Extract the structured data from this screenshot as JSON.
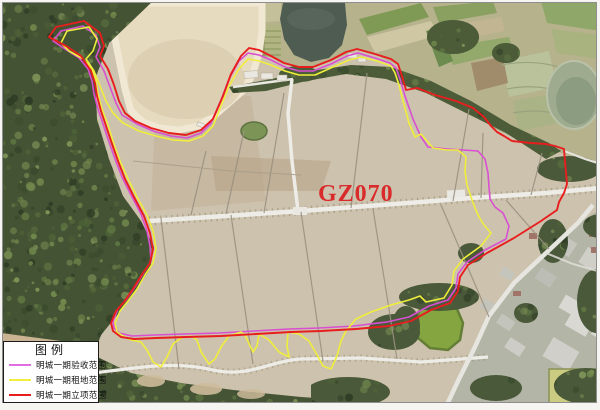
{
  "map": {
    "site_label": "GZ070",
    "site_label_color": "#d92b2b"
  },
  "legend": {
    "title": "图例",
    "items": [
      {
        "id": "acceptance",
        "label": "明城一期验收范围",
        "color": "#e06ee0"
      },
      {
        "id": "lease",
        "label": "明城一期租地范围",
        "color": "#f2ee3e"
      },
      {
        "id": "approval",
        "label": "明城一期立项范围",
        "color": "#e81e1e"
      }
    ]
  },
  "overlays": [
    {
      "name": "acceptance-boundary",
      "color": "#d94fd2",
      "width": 1.6,
      "closed": true,
      "points": [
        [
          52,
          40
        ],
        [
          60,
          30
        ],
        [
          82,
          25
        ],
        [
          95,
          34
        ],
        [
          99,
          46
        ],
        [
          95,
          56
        ],
        [
          103,
          70
        ],
        [
          109,
          86
        ],
        [
          115,
          102
        ],
        [
          121,
          114
        ],
        [
          136,
          123
        ],
        [
          152,
          130
        ],
        [
          170,
          135
        ],
        [
          186,
          137
        ],
        [
          200,
          132
        ],
        [
          210,
          122
        ],
        [
          220,
          99
        ],
        [
          228,
          78
        ],
        [
          238,
          60
        ],
        [
          247,
          52
        ],
        [
          258,
          54
        ],
        [
          270,
          59
        ],
        [
          284,
          66
        ],
        [
          298,
          70
        ],
        [
          312,
          70
        ],
        [
          330,
          63
        ],
        [
          346,
          55
        ],
        [
          357,
          52
        ],
        [
          374,
          57
        ],
        [
          389,
          62
        ],
        [
          395,
          67
        ],
        [
          399,
          78
        ],
        [
          404,
          95
        ],
        [
          412,
          118
        ],
        [
          420,
          136
        ],
        [
          427,
          146
        ],
        [
          446,
          148
        ],
        [
          462,
          149
        ],
        [
          477,
          150
        ],
        [
          484,
          158
        ],
        [
          487,
          172
        ],
        [
          488,
          186
        ],
        [
          489,
          198
        ],
        [
          494,
          206
        ],
        [
          502,
          212
        ],
        [
          508,
          225
        ],
        [
          505,
          238
        ],
        [
          484,
          249
        ],
        [
          466,
          261
        ],
        [
          457,
          273
        ],
        [
          455,
          287
        ],
        [
          447,
          299
        ],
        [
          428,
          305
        ],
        [
          408,
          316
        ],
        [
          386,
          321
        ],
        [
          353,
          325
        ],
        [
          318,
          327
        ],
        [
          288,
          328
        ],
        [
          253,
          330
        ],
        [
          218,
          332
        ],
        [
          183,
          333
        ],
        [
          153,
          334
        ],
        [
          131,
          335
        ],
        [
          118,
          332
        ],
        [
          113,
          327
        ],
        [
          112,
          320
        ],
        [
          117,
          308
        ],
        [
          125,
          299
        ],
        [
          134,
          286
        ],
        [
          142,
          273
        ],
        [
          150,
          260
        ],
        [
          149,
          245
        ],
        [
          146,
          230
        ],
        [
          140,
          213
        ],
        [
          130,
          194
        ],
        [
          121,
          176
        ],
        [
          114,
          158
        ],
        [
          107,
          138
        ],
        [
          102,
          123
        ],
        [
          97,
          108
        ],
        [
          93,
          93
        ],
        [
          91,
          80
        ],
        [
          87,
          68
        ],
        [
          78,
          57
        ],
        [
          64,
          48
        ]
      ]
    },
    {
      "name": "lease-boundary",
      "color": "#f0ee3c",
      "width": 1.6,
      "closed": true,
      "points": [
        [
          60,
          42
        ],
        [
          66,
          30
        ],
        [
          88,
          26
        ],
        [
          96,
          38
        ],
        [
          92,
          50
        ],
        [
          85,
          58
        ],
        [
          93,
          70
        ],
        [
          99,
          85
        ],
        [
          105,
          100
        ],
        [
          112,
          112
        ],
        [
          122,
          122
        ],
        [
          138,
          130
        ],
        [
          155,
          135
        ],
        [
          172,
          139
        ],
        [
          188,
          140
        ],
        [
          202,
          135
        ],
        [
          212,
          125
        ],
        [
          220,
          105
        ],
        [
          228,
          85
        ],
        [
          238,
          68
        ],
        [
          247,
          58
        ],
        [
          258,
          60
        ],
        [
          270,
          64
        ],
        [
          284,
          70
        ],
        [
          298,
          74
        ],
        [
          314,
          74
        ],
        [
          332,
          66
        ],
        [
          348,
          59
        ],
        [
          360,
          56
        ],
        [
          376,
          60
        ],
        [
          390,
          65
        ],
        [
          394,
          72
        ],
        [
          398,
          84
        ],
        [
          402,
          100
        ],
        [
          408,
          122
        ],
        [
          414,
          136
        ],
        [
          420,
          133
        ],
        [
          432,
          147
        ],
        [
          446,
          149
        ],
        [
          457,
          149
        ],
        [
          465,
          156
        ],
        [
          464,
          170
        ],
        [
          466,
          184
        ],
        [
          470,
          196
        ],
        [
          474,
          207
        ],
        [
          478,
          216
        ],
        [
          483,
          224
        ],
        [
          490,
          232
        ],
        [
          480,
          245
        ],
        [
          462,
          258
        ],
        [
          453,
          270
        ],
        [
          451,
          284
        ],
        [
          443,
          297
        ],
        [
          425,
          301
        ],
        [
          419,
          295
        ],
        [
          408,
          299
        ],
        [
          390,
          304
        ],
        [
          370,
          311
        ],
        [
          355,
          318
        ],
        [
          345,
          330
        ],
        [
          340,
          340
        ],
        [
          336,
          355
        ],
        [
          330,
          368
        ],
        [
          322,
          365
        ],
        [
          315,
          352
        ],
        [
          308,
          340
        ],
        [
          298,
          333
        ],
        [
          287,
          331
        ],
        [
          286,
          345
        ],
        [
          288,
          356
        ],
        [
          278,
          351
        ],
        [
          268,
          339
        ],
        [
          258,
          333
        ],
        [
          256,
          345
        ],
        [
          252,
          351
        ],
        [
          244,
          334
        ],
        [
          240,
          331
        ],
        [
          228,
          335
        ],
        [
          220,
          346
        ],
        [
          214,
          358
        ],
        [
          208,
          363
        ],
        [
          200,
          351
        ],
        [
          196,
          339
        ],
        [
          190,
          335
        ],
        [
          180,
          337
        ],
        [
          172,
          343
        ],
        [
          166,
          356
        ],
        [
          160,
          366
        ],
        [
          152,
          361
        ],
        [
          146,
          349
        ],
        [
          140,
          341
        ],
        [
          130,
          339
        ],
        [
          122,
          335
        ],
        [
          116,
          331
        ],
        [
          114,
          322
        ],
        [
          119,
          310
        ],
        [
          127,
          300
        ],
        [
          136,
          288
        ],
        [
          144,
          274
        ],
        [
          152,
          262
        ],
        [
          155,
          248
        ],
        [
          152,
          230
        ],
        [
          146,
          214
        ],
        [
          136,
          196
        ],
        [
          127,
          178
        ],
        [
          119,
          160
        ],
        [
          112,
          140
        ],
        [
          107,
          124
        ],
        [
          101,
          108
        ],
        [
          97,
          93
        ],
        [
          95,
          80
        ],
        [
          91,
          68
        ],
        [
          82,
          58
        ],
        [
          68,
          50
        ]
      ]
    },
    {
      "name": "approval-boundary",
      "color": "#e81e1e",
      "width": 1.9,
      "closed": true,
      "points": [
        [
          48,
          36
        ],
        [
          55,
          26
        ],
        [
          83,
          20
        ],
        [
          99,
          32
        ],
        [
          103,
          45
        ],
        [
          99,
          55
        ],
        [
          107,
          68
        ],
        [
          113,
          84
        ],
        [
          118,
          100
        ],
        [
          124,
          112
        ],
        [
          134,
          120
        ],
        [
          150,
          127
        ],
        [
          168,
          132
        ],
        [
          185,
          134
        ],
        [
          200,
          129
        ],
        [
          212,
          118
        ],
        [
          222,
          95
        ],
        [
          230,
          73
        ],
        [
          240,
          55
        ],
        [
          248,
          47
        ],
        [
          258,
          49
        ],
        [
          270,
          55
        ],
        [
          283,
          62
        ],
        [
          298,
          66
        ],
        [
          312,
          66
        ],
        [
          330,
          59
        ],
        [
          345,
          51
        ],
        [
          356,
          48
        ],
        [
          374,
          53
        ],
        [
          390,
          58
        ],
        [
          397,
          63
        ],
        [
          401,
          75
        ],
        [
          405,
          89
        ],
        [
          416,
          87
        ],
        [
          434,
          94
        ],
        [
          455,
          100
        ],
        [
          472,
          107
        ],
        [
          483,
          116
        ],
        [
          490,
          125
        ],
        [
          496,
          131
        ],
        [
          503,
          135
        ],
        [
          511,
          140
        ],
        [
          530,
          142
        ],
        [
          545,
          143
        ],
        [
          554,
          145
        ],
        [
          563,
          148
        ],
        [
          564,
          160
        ],
        [
          565,
          172
        ],
        [
          566,
          183
        ],
        [
          563,
          192
        ],
        [
          558,
          201
        ],
        [
          556,
          209
        ],
        [
          540,
          220
        ],
        [
          513,
          237
        ],
        [
          486,
          252
        ],
        [
          467,
          264
        ],
        [
          459,
          276
        ],
        [
          457,
          290
        ],
        [
          449,
          302
        ],
        [
          430,
          309
        ],
        [
          410,
          320
        ],
        [
          388,
          325
        ],
        [
          355,
          328
        ],
        [
          320,
          330
        ],
        [
          290,
          331
        ],
        [
          255,
          333
        ],
        [
          220,
          335
        ],
        [
          185,
          336
        ],
        [
          155,
          337
        ],
        [
          133,
          338
        ],
        [
          120,
          336
        ],
        [
          112,
          330
        ],
        [
          110,
          322
        ],
        [
          115,
          310
        ],
        [
          123,
          301
        ],
        [
          132,
          288
        ],
        [
          140,
          275
        ],
        [
          149,
          262
        ],
        [
          152,
          248
        ],
        [
          149,
          232
        ],
        [
          143,
          215
        ],
        [
          133,
          196
        ],
        [
          124,
          178
        ],
        [
          117,
          160
        ],
        [
          110,
          140
        ],
        [
          105,
          125
        ],
        [
          100,
          110
        ],
        [
          96,
          95
        ],
        [
          94,
          82
        ],
        [
          90,
          70
        ],
        [
          80,
          55
        ],
        [
          65,
          45
        ]
      ]
    }
  ]
}
